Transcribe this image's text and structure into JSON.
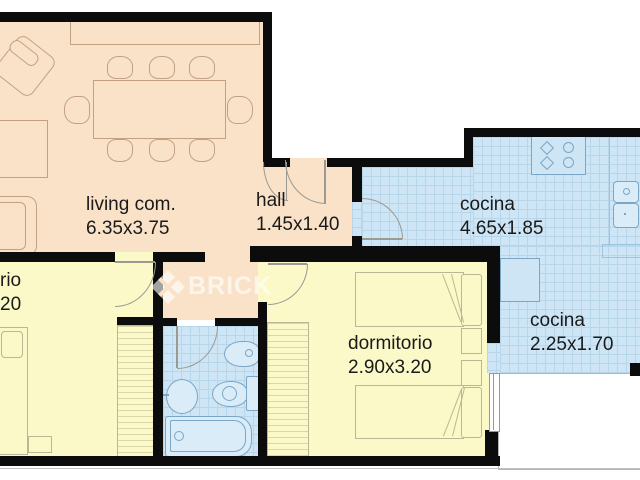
{
  "title": "apartment floor plan",
  "watermark": {
    "brand": "BRICK",
    "logo": "brick-diamond-logo"
  },
  "rooms": [
    {
      "name": "living-room",
      "label": "living com.",
      "dims": "6.35x3.75"
    },
    {
      "name": "hall",
      "label": "hall",
      "dims": "1.45x1.40"
    },
    {
      "name": "kitchen",
      "label": "cocina",
      "dims": "4.65x1.85"
    },
    {
      "name": "kitchen-2",
      "label": "cocina",
      "dims": "2.25x1.70"
    },
    {
      "name": "bedroom",
      "label": "dormitorio",
      "dims": "2.90x3.20"
    },
    {
      "name": "bedroom-left-partial",
      "label": "rio",
      "dims": "20"
    }
  ],
  "colors": {
    "living_floor": "#fae2c8",
    "bedroom_floor": "#fbf9c8",
    "wet_room_floor": "#cde5f4",
    "wall": "#0c0c0c",
    "text": "#1a1a1a"
  }
}
